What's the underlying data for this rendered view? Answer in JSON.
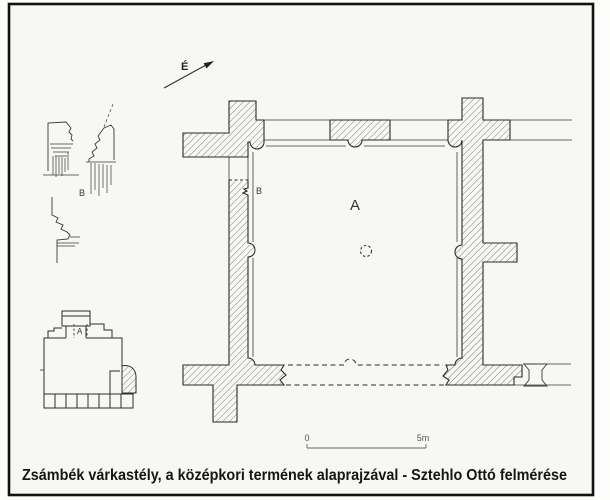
{
  "figure": {
    "caption": "Zsámbék várkastély, a középkori termének alaprajzával - Sztehlo Ottó felmérése",
    "north_arrow_label": "É",
    "main_plan": {
      "room_label": "A",
      "moulding_marker_label": "B"
    },
    "detail_drawings": {
      "marker_label": "B"
    },
    "site_plan": {
      "hall_label": "A"
    },
    "scale_bar": {
      "start_label": "0",
      "end_label": "5m"
    },
    "colors": {
      "ink": "#2b2b2b",
      "paper": "#f7f7f4",
      "hatch": "#555555"
    }
  }
}
